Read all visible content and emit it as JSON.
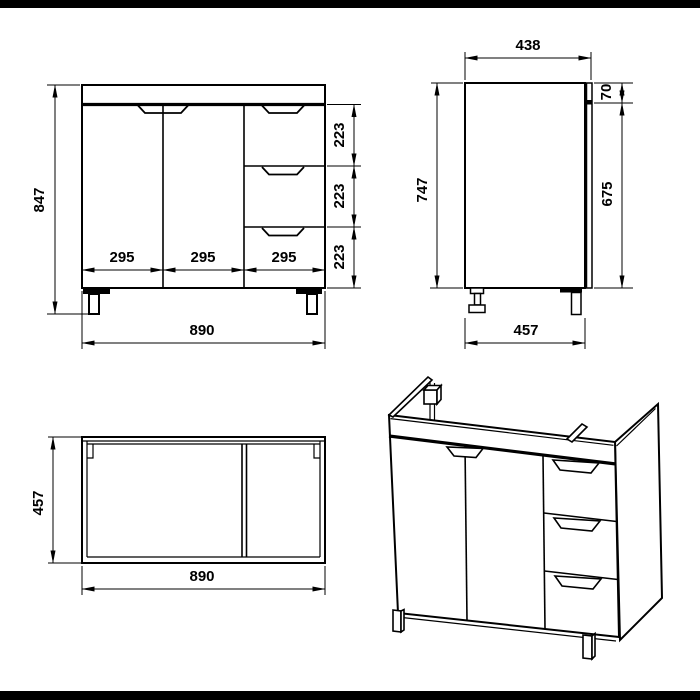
{
  "colors": {
    "line": "#000000",
    "background": "#ffffff",
    "letterbox": "#000000"
  },
  "views": {
    "front": {
      "total_height": "847",
      "overall_width": "890",
      "section_widths": [
        "295",
        "295",
        "295"
      ],
      "drawer_heights": [
        "223",
        "223",
        "223"
      ]
    },
    "side": {
      "top_depth": "438",
      "body_height": "747",
      "front_panel_height": "675",
      "top_rail_height": "70",
      "bottom_depth": "457"
    },
    "top": {
      "depth": "457",
      "width": "890"
    }
  }
}
